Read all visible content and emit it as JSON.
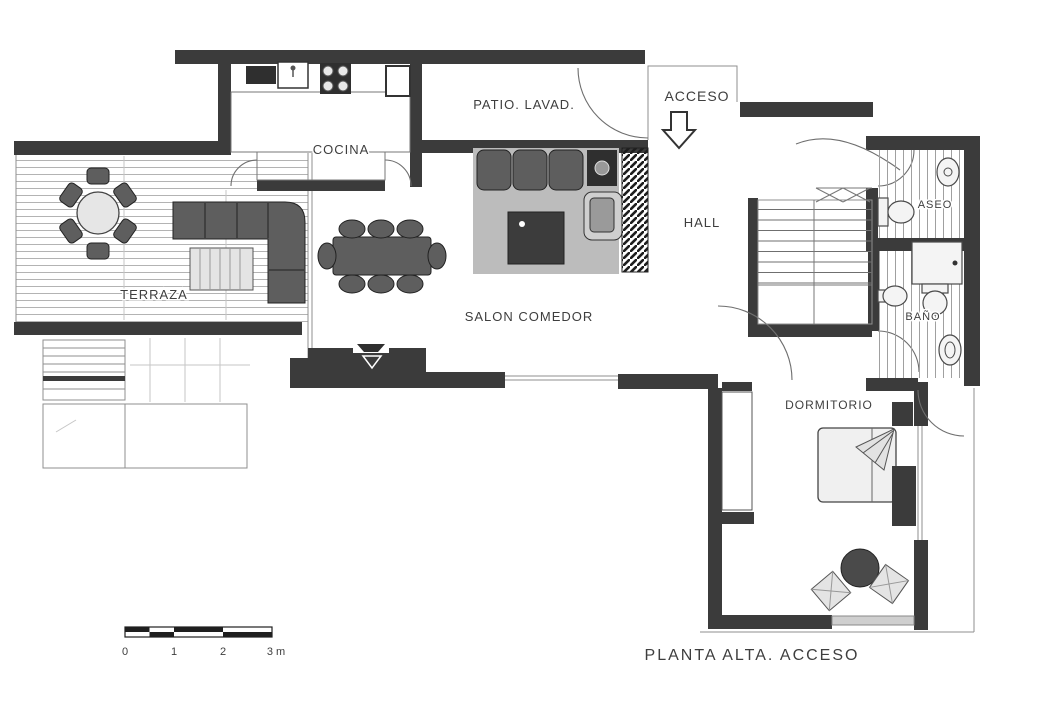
{
  "title": "PLANTA ALTA. ACCESO",
  "plan": {
    "rooms": [
      {
        "id": "terraza",
        "label": "TERRAZA"
      },
      {
        "id": "cocina",
        "label": "COCINA"
      },
      {
        "id": "patio",
        "label": "PATIO. LAVAD."
      },
      {
        "id": "acceso",
        "label": "ACCESO"
      },
      {
        "id": "hall",
        "label": "HALL"
      },
      {
        "id": "salon",
        "label": "SALON COMEDOR"
      },
      {
        "id": "aseo",
        "label": "ASEO"
      },
      {
        "id": "bano",
        "label": "BAÑO"
      },
      {
        "id": "dormitorio",
        "label": "DORMITORIO"
      }
    ],
    "scale_bar": {
      "ticks": [
        "0",
        "1",
        "2",
        "3 m"
      ]
    },
    "colors": {
      "wall": "#3b3b3b",
      "furniture_dark": "#5e5e5e",
      "rug": "#bcbcbc",
      "hatch_line": "#9a9a9a",
      "label": "#3e3e3e",
      "background": "#ffffff"
    }
  }
}
